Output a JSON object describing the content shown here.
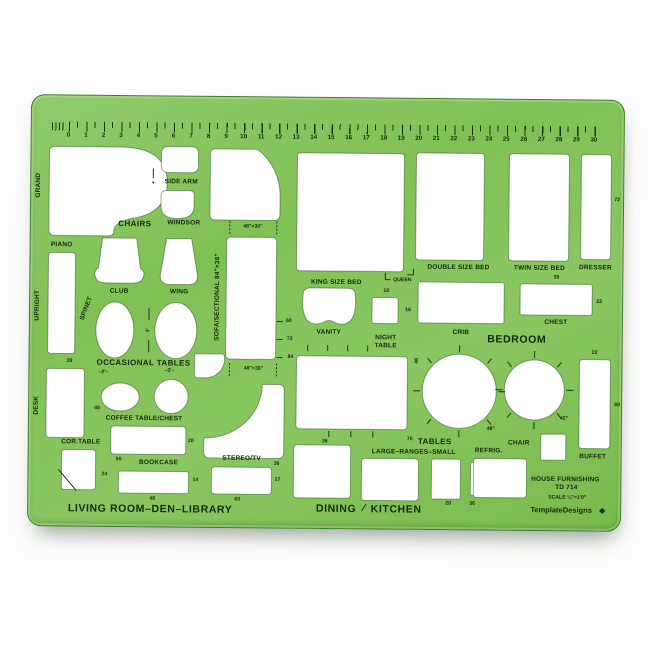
{
  "template": {
    "product_line1": "HOUSE FURNISHING",
    "product_line2": "TD 714",
    "scale_text": "SCALE ¼\"=1'0\"",
    "brand": "TemplateDesigns",
    "brand_mark": "◆",
    "color": "#80c155"
  },
  "ruler": {
    "numbers": [
      "0",
      "1",
      "2",
      "3",
      "4",
      "5",
      "6",
      "7",
      "8",
      "9",
      "10",
      "11",
      "12",
      "13",
      "14",
      "15",
      "16",
      "17",
      "18",
      "19",
      "20",
      "21",
      "22",
      "23",
      "24",
      "25",
      "26",
      "27",
      "28",
      "29",
      "30"
    ]
  },
  "labels": {
    "grand": "GRAND",
    "piano": "PIANO",
    "upright": "UPRIGHT",
    "spinet": "SPINET",
    "chairs": "CHAIRS",
    "side_arm": "SIDE ARM",
    "windsor": "WINDSOR",
    "club": "CLUB",
    "wing": "WING",
    "occasional": "OCCASIONAL TABLES",
    "dim_2ft": "–2'–",
    "dim_3ft": "–3'–",
    "dim_3ft_vert": "3'",
    "desk": "DESK",
    "coffee": "COFFEE TABLE/CHEST",
    "cor_table": "COR.TABLE",
    "bookcase": "BOOKCASE",
    "stereo": "STEREO/TV",
    "living": "LIVING ROOM–DEN–LIBRARY",
    "sofa": "SOFA/SECTIONAL  84\"×36\"",
    "dim48x30": "48\"×30\"",
    "dim48x36": "48\"×36\"",
    "king": "KING SIZE BED",
    "queen": "QUEEN",
    "double": "DOUBLE SIZE BED",
    "twin": "TWIN SIZE BED",
    "dresser": "DRESSER",
    "vanity": "VANITY",
    "night_line1": "NIGHT",
    "night_line2": "TABLE",
    "crib": "CRIB",
    "chest": "CHEST",
    "bedroom": "BEDROOM",
    "tables": "TABLES",
    "ranges": "LARGE–RANGES–SMALL",
    "chair": "CHAIR",
    "refrig": "REFRIG.",
    "buffet": "BUFFET",
    "dining": "DINING",
    "divider": "∕",
    "kitchen": "KITCHEN",
    "circle_48": "48\"",
    "circle_42": "42\""
  },
  "numbers": {
    "upright39": "39",
    "desk48": "48",
    "coffee20": "20",
    "cor24": "24",
    "book50": "50",
    "book14": "14",
    "book48": "48",
    "book60": "60",
    "stereo17": "17",
    "sofa60": "60",
    "sofa72": "72",
    "sofa84": "84",
    "queen18": "18",
    "night18": "18",
    "twin39": "39",
    "dresser72": "72",
    "chest22": "22",
    "buffet22": "22",
    "buffet60": "60",
    "tables70": "70",
    "dining36a": "36",
    "dining36b": "36",
    "range20": "20",
    "range36": "36",
    "crib48": "48"
  }
}
